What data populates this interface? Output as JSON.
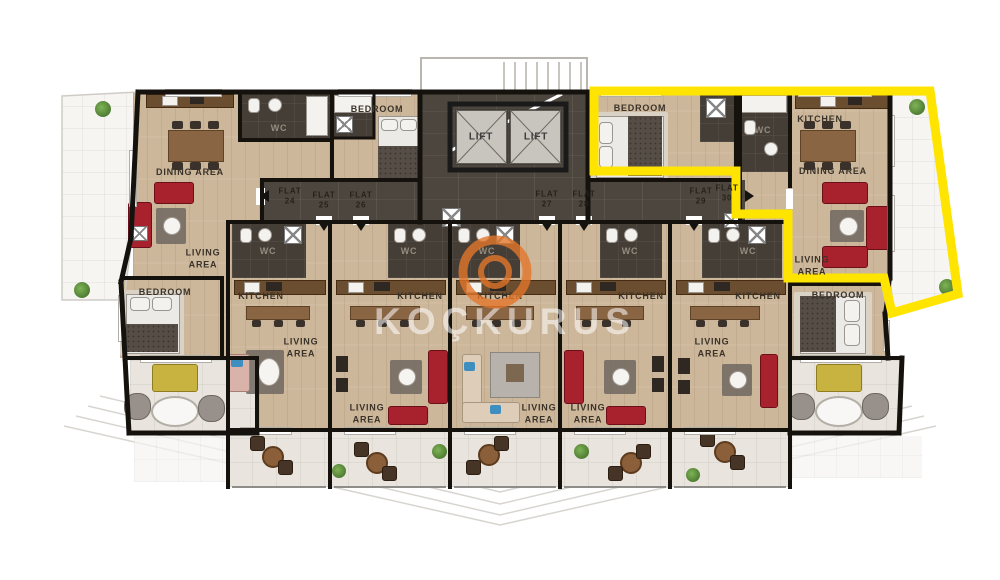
{
  "document": {
    "type": "apartment floor plan",
    "highlighted_flat": "30",
    "highlight_color": "#ffe400"
  },
  "watermark": {
    "text": "KOÇKURUS",
    "ring_color": "#e2762a"
  },
  "flats": [
    {
      "id": "24",
      "tag": "FLAT\n24",
      "x": 290,
      "y": 197,
      "entrance": "left"
    },
    {
      "id": "25",
      "tag": "FLAT\n25",
      "x": 324,
      "y": 201,
      "entrance": "down"
    },
    {
      "id": "26",
      "tag": "FLAT\n26",
      "x": 361,
      "y": 201,
      "entrance": "down"
    },
    {
      "id": "27",
      "tag": "FLAT\n27",
      "x": 547,
      "y": 200,
      "entrance": "down"
    },
    {
      "id": "28",
      "tag": "FLAT\n28",
      "x": 584,
      "y": 200,
      "entrance": "down"
    },
    {
      "id": "29",
      "tag": "FLAT\n29",
      "x": 701,
      "y": 197,
      "entrance": "down"
    },
    {
      "id": "30",
      "tag": "FLAT\n30",
      "x": 727,
      "y": 194,
      "entrance": "right"
    }
  ],
  "entrance_arrows": [
    {
      "flat": "24",
      "dir": "left",
      "x": 266,
      "y": 196
    },
    {
      "flat": "25",
      "dir": "down",
      "x": 324,
      "y": 228
    },
    {
      "flat": "26",
      "dir": "down",
      "x": 361,
      "y": 228
    },
    {
      "flat": "27",
      "dir": "down",
      "x": 547,
      "y": 228
    },
    {
      "flat": "28",
      "dir": "down",
      "x": 584,
      "y": 228
    },
    {
      "flat": "29",
      "dir": "down",
      "x": 694,
      "y": 228
    },
    {
      "flat": "30",
      "dir": "right",
      "x": 751,
      "y": 196
    }
  ],
  "labels": [
    {
      "name": "label-dining-area-flat24",
      "text": "DINING AREA",
      "x": 190,
      "y": 173
    },
    {
      "name": "label-wc-flat24",
      "text": "WC",
      "x": 279,
      "y": 129,
      "c": "#958c80"
    },
    {
      "name": "label-bedroom-flat25",
      "text": "BEDROOM",
      "x": 377,
      "y": 110
    },
    {
      "name": "label-lift-1",
      "text": "LIFT",
      "x": 481,
      "y": 137,
      "s": 10,
      "c": "#3c3c3c"
    },
    {
      "name": "label-lift-2",
      "text": "LIFT",
      "x": 536,
      "y": 137,
      "s": 10,
      "c": "#3c3c3c"
    },
    {
      "name": "label-bedroom-flat30",
      "text": "BEDROOM",
      "x": 640,
      "y": 109
    },
    {
      "name": "label-wc-flat30",
      "text": "WC",
      "x": 763,
      "y": 131,
      "c": "#958c80"
    },
    {
      "name": "label-kitchen-flat30",
      "text": "KITCHEN",
      "x": 820,
      "y": 120
    },
    {
      "name": "label-dining-area-flat30",
      "text": "DINING AREA",
      "x": 833,
      "y": 172
    },
    {
      "name": "label-living-area-flat24",
      "text": "LIVING\nAREA",
      "x": 203,
      "y": 259
    },
    {
      "name": "label-living-area-flat30",
      "text": "LIVING\nAREA",
      "x": 812,
      "y": 266
    },
    {
      "name": "label-wc-1",
      "text": "WC",
      "x": 268,
      "y": 252,
      "c": "#958c80"
    },
    {
      "name": "label-kitchen-1",
      "text": "KITCHEN",
      "x": 261,
      "y": 297
    },
    {
      "name": "label-living-1",
      "text": "LIVING\nAREA",
      "x": 301,
      "y": 348
    },
    {
      "name": "label-wc-2",
      "text": "WC",
      "x": 409,
      "y": 252,
      "c": "#958c80"
    },
    {
      "name": "label-kitchen-2",
      "text": "KITCHEN",
      "x": 420,
      "y": 297
    },
    {
      "name": "label-living-2",
      "text": "LIVING\nAREA",
      "x": 367,
      "y": 414
    },
    {
      "name": "label-wc-3",
      "text": "WC",
      "x": 487,
      "y": 252,
      "c": "#958c80"
    },
    {
      "name": "label-kitchen-3",
      "text": "KITCHEN",
      "x": 500,
      "y": 297
    },
    {
      "name": "label-living-3",
      "text": "LIVING\nAREA",
      "x": 539,
      "y": 414
    },
    {
      "name": "label-wc-4",
      "text": "WC",
      "x": 630,
      "y": 252,
      "c": "#958c80"
    },
    {
      "name": "label-kitchen-4",
      "text": "KITCHEN",
      "x": 641,
      "y": 297
    },
    {
      "name": "label-living-4",
      "text": "LIVING\nAREA",
      "x": 588,
      "y": 414
    },
    {
      "name": "label-wc-5",
      "text": "WC",
      "x": 748,
      "y": 252,
      "c": "#958c80"
    },
    {
      "name": "label-kitchen-5",
      "text": "KITCHEN",
      "x": 758,
      "y": 297
    },
    {
      "name": "label-living-5",
      "text": "LIVING\nAREA",
      "x": 712,
      "y": 348
    },
    {
      "name": "label-bedroom-flat29",
      "text": "BEDROOM",
      "x": 838,
      "y": 296
    },
    {
      "name": "label-bedroom-flat24",
      "text": "BEDROOM",
      "x": 165,
      "y": 293
    }
  ]
}
